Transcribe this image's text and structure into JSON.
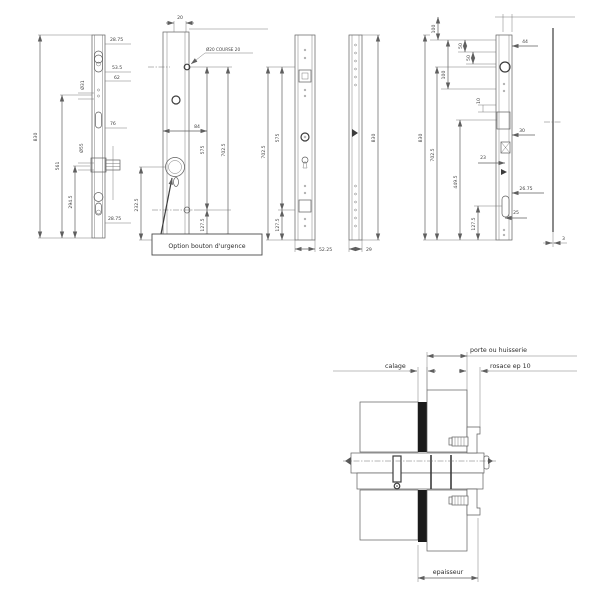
{
  "page": {
    "background": "#ffffff",
    "line_color": "#5f5f5f",
    "text_color": "#3f3f3f"
  },
  "views": {
    "faceplate_a": {
      "dims": {
        "overall": "830",
        "top": "28.75",
        "a": "53.5",
        "b": "62",
        "hole_top": "Ø31",
        "c": "76",
        "hole_mid": "Ø55",
        "d": "561",
        "e": "294.5",
        "bottom": "28.75"
      }
    },
    "lock_case": {
      "dims": {
        "top": "20",
        "course": "Ø20 COURSE 20",
        "backset": "84",
        "a": "575",
        "b": "702.5",
        "c": "232.5",
        "d": "127.5"
      },
      "note": "Option bouton d'urgence"
    },
    "faceplate_b": {
      "dims": {
        "a": "702.5",
        "b": "575",
        "c": "127.5",
        "width": "52.25"
      }
    },
    "strip": {
      "dims": {
        "height": "830",
        "width": "29"
      }
    },
    "faceplate_c": {
      "dims": {
        "overall": "830",
        "a": "702.5",
        "b": "449.5",
        "c": "127.5",
        "t1": "100",
        "t2": "50",
        "t3": "50",
        "t4": "100",
        "t5": "10",
        "r1": "44",
        "r2": "30",
        "r3": "23",
        "r4": "26.75",
        "r5": "25"
      }
    },
    "side_plate": {
      "dims": {
        "thickness": "3"
      }
    }
  },
  "cross_section": {
    "labels": {
      "porte": "porte ou huisserie",
      "calage": "calage",
      "rosace": "rosace ep 10",
      "epaisseur": "epaisseur"
    }
  }
}
